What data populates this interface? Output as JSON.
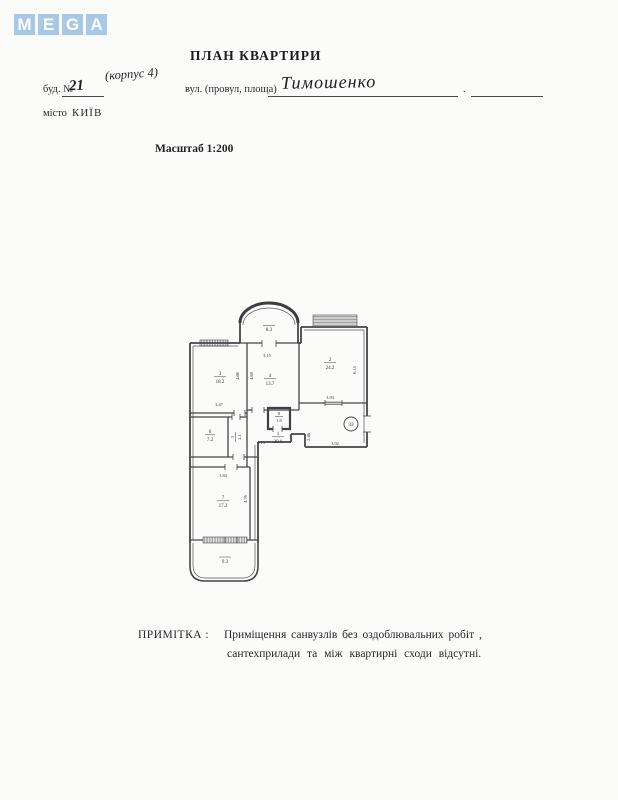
{
  "logo": {
    "letters": [
      "M",
      "E",
      "G",
      "A"
    ],
    "color": "#a7c9e7"
  },
  "header": {
    "title": "ПЛАН КВАРТИРИ",
    "building_label": "буд. №",
    "building_number": "21",
    "block_note": "(корпус 4)",
    "street_label": "вул. (провул, площа)",
    "street_value": "Тимошенко",
    "separator": ".",
    "city_label": "місто",
    "city_value": "КИЇВ",
    "scale": "Масштаб 1:200"
  },
  "plan": {
    "apartment_number": "32",
    "rooms": {
      "r1": {
        "num": "1",
        "area": "20.6"
      },
      "r2": {
        "num": "2",
        "area": "24.2"
      },
      "r3": {
        "num": "3",
        "area": "18.2"
      },
      "r4": {
        "num": "4",
        "area": "13.7"
      },
      "r5": {
        "num": "5",
        "area": "2.1"
      },
      "r6": {
        "num": "6",
        "area": "7.2"
      },
      "r7": {
        "num": "7",
        "area": "17.2"
      },
      "r8": {
        "num": "8",
        "area": "1.8"
      }
    },
    "balconies": {
      "top": "8.3",
      "bottom": "9.3"
    },
    "dims": {
      "room4_top": "3.15",
      "room3_side": "4.66",
      "room4_side": "4.68",
      "room3_bottom": "3.47",
      "room2_side": "6.15",
      "room2_bottom": "3.93",
      "hall_left": "4.13",
      "hall_depth": "2.46",
      "entry_bottom": "3.92",
      "room7_top": "3.84",
      "room7_side": "4.76"
    }
  },
  "note": {
    "label": "ПРИМІТКА :",
    "line1": "Приміщення санвузлів без оздоблювальних робіт ,",
    "line2": "сантехприлади та між квартирні сходи відсутні."
  }
}
